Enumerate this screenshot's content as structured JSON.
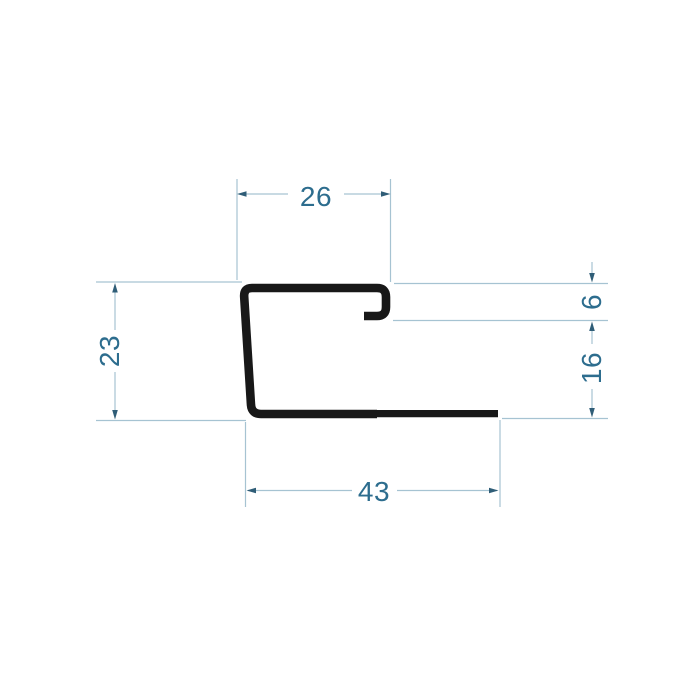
{
  "drawing": {
    "background_color": "#ffffff",
    "profile_color": "#181818",
    "line_color": "#a6c3d2",
    "arrow_color": "#2f5d77",
    "text_color": "#2d6d8e",
    "dimensions": {
      "top_width": "26",
      "left_height": "23",
      "hook_height": "6",
      "right_lower_height": "16",
      "bottom_width": "43"
    }
  }
}
